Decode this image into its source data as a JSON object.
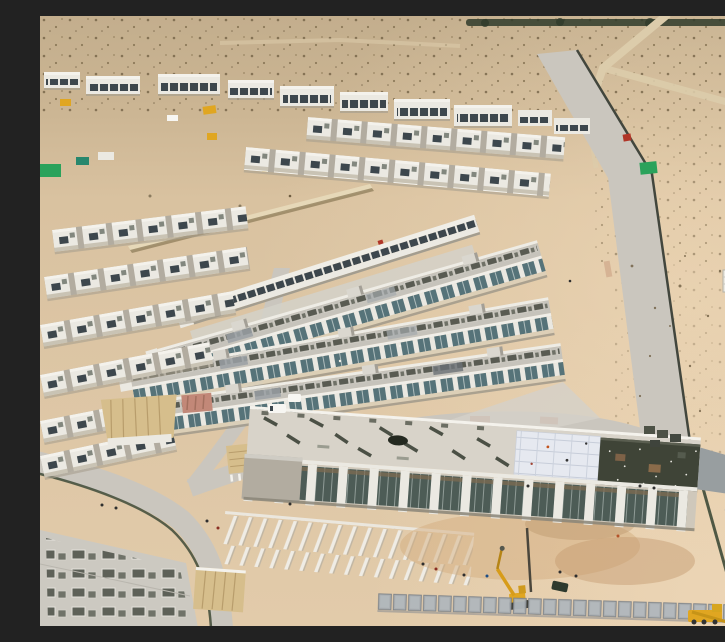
{
  "meta": {
    "type": "aerial-drone-photograph",
    "alt": "Aerial drone view of a desert residential construction site: parallel diagonal rows of white townhouses with rooftop AC units and teal glass facades, a distant row of white villas on the horizon, scrub-dotted desert, a light concrete perimeter road with dark boundary fencing, a long community building under construction in the foreground with material stacks on its roof, a bright insulation-panel roof section and a dark gravel roof section, a yellow excavator, site hoarding panels, canopies and scattered workers.",
    "width_px": 725,
    "height_px": 610
  },
  "colors": {
    "sand_far": "#c3ae8d",
    "sand_mid": "#d9c2a0",
    "sand_warm": "#e2cbaa",
    "sand_bright": "#f0d9b8",
    "track": "#dcccab",
    "scrub": "#6e5d41",
    "treeline": "#2f3b2a",
    "white_bld": "#ebe9e2",
    "white_hi": "#f4f2ec",
    "bld_shadow": "#b2aca0",
    "win_dark": "#3d474d",
    "glass_teal": "#567379",
    "roof_gray": "#c6c3bb",
    "ac_dark": "#53564d",
    "apron": "#d4d1c9",
    "road": "#cac6be",
    "road_pink": "#b4735c",
    "fence_dark": "#42463d",
    "fence_green": "#3e4a37",
    "hoard": "#a7adb2",
    "bigroof": "#d8d3c9",
    "panel_bright": "#e6e9f0",
    "roof_dark": "#3f4437",
    "facade_tan": "#cfc8bb",
    "brick": "#7d6b52",
    "wall_gray": "#989ea0",
    "terrace": "#dccfb8",
    "canopy": "#d6be8c",
    "debris_pink": "#c28878",
    "machine_yellow": "#e0a621",
    "container_green": "#2aa25b",
    "van_white": "#f7f6f2"
  },
  "scene": {
    "regions": [
      {
        "name": "distant-desert",
        "desc": "pale scrub-dotted desert with dirt tracks and a dark tree line at the horizon"
      },
      {
        "name": "distant-villa-row",
        "desc": "row of white two-storey villas across the upper left"
      },
      {
        "name": "construction-yard",
        "desc": "open sand with machinery, containers and a long low material wall"
      },
      {
        "name": "townhouse-estate",
        "desc": "diagonal rows of white townhouses, gray roofs with AC units, teal glazed fronts"
      },
      {
        "name": "perimeter-road",
        "desc": "light concrete road running down the right side with a dark fence"
      },
      {
        "name": "community-building",
        "desc": "long building under construction with cluttered roof, bright panel section and dark gravel roof end"
      },
      {
        "name": "foreground-works",
        "desc": "excavation, yellow excavator, gray site hoarding, workers, curved access road"
      }
    ],
    "objects": [
      "white-van",
      "green-container",
      "yellow-excavator",
      "mobile-crane",
      "site-hut",
      "power-pole",
      "red-marker",
      "material-stacks",
      "tan-canopy",
      "pink-debris-pile"
    ]
  }
}
